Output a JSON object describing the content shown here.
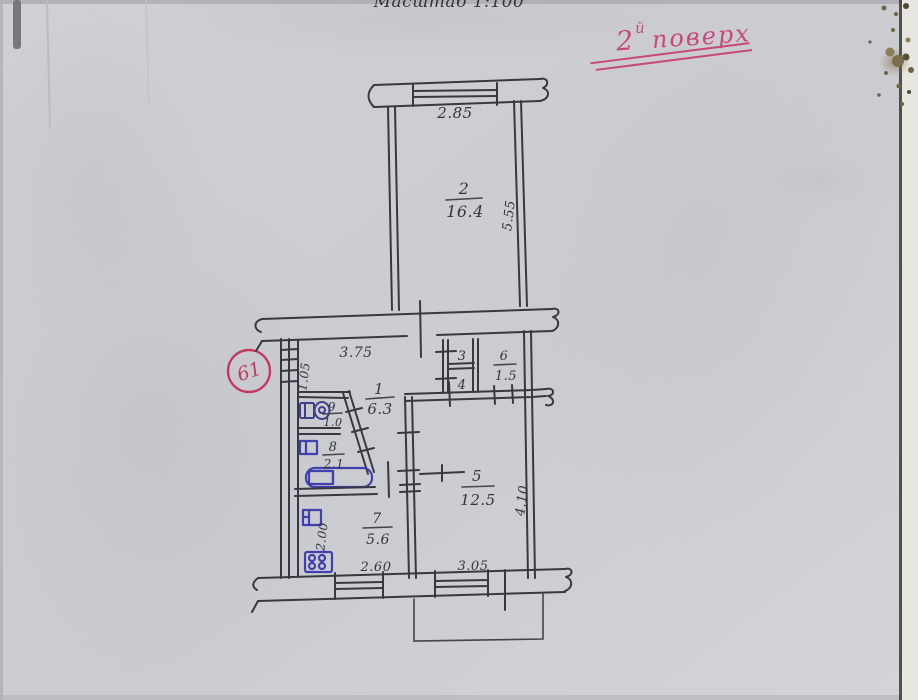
{
  "doc": {
    "scale_label": "Масштаб 1:100",
    "floor": {
      "num": "2",
      "sup": "й",
      "word": "поверх"
    },
    "apartment_number": "61"
  },
  "rooms": {
    "r1": {
      "num": "1",
      "area": "6.3"
    },
    "r2": {
      "num": "2",
      "area": "16.4"
    },
    "r3": {
      "num": "3"
    },
    "r4": {
      "num": "4"
    },
    "r5": {
      "num": "5",
      "area": "12.5"
    },
    "r6": {
      "num": "6",
      "area": "1.5"
    },
    "r7": {
      "num": "7",
      "area": "5.6"
    },
    "r8": {
      "num": "8",
      "area": "2.1"
    },
    "r9": {
      "num": "9",
      "area": "1.0"
    }
  },
  "dims": {
    "room2_width": "2.85",
    "room2_depth": "5.55",
    "hall_width": "3.75",
    "entry_width": "1.05",
    "kitchen_depth": "2.00",
    "kitchen_window_width": "2.60",
    "room5_window_width": "3.05",
    "room5_depth": "4.10"
  },
  "fixtures": {
    "toilet": "toilet-icon",
    "bath_sink": "sink-icon",
    "bathtub": "bathtub-icon",
    "kitchen_sink": "kitchen-sink-icon",
    "stove": "stove-icon"
  },
  "colors": {
    "paper": "#cdced2",
    "ink": "#383940",
    "fixture_blue": "#4140ae",
    "stamp_red": "#c23a60",
    "floor_pink": "#c8487c"
  }
}
